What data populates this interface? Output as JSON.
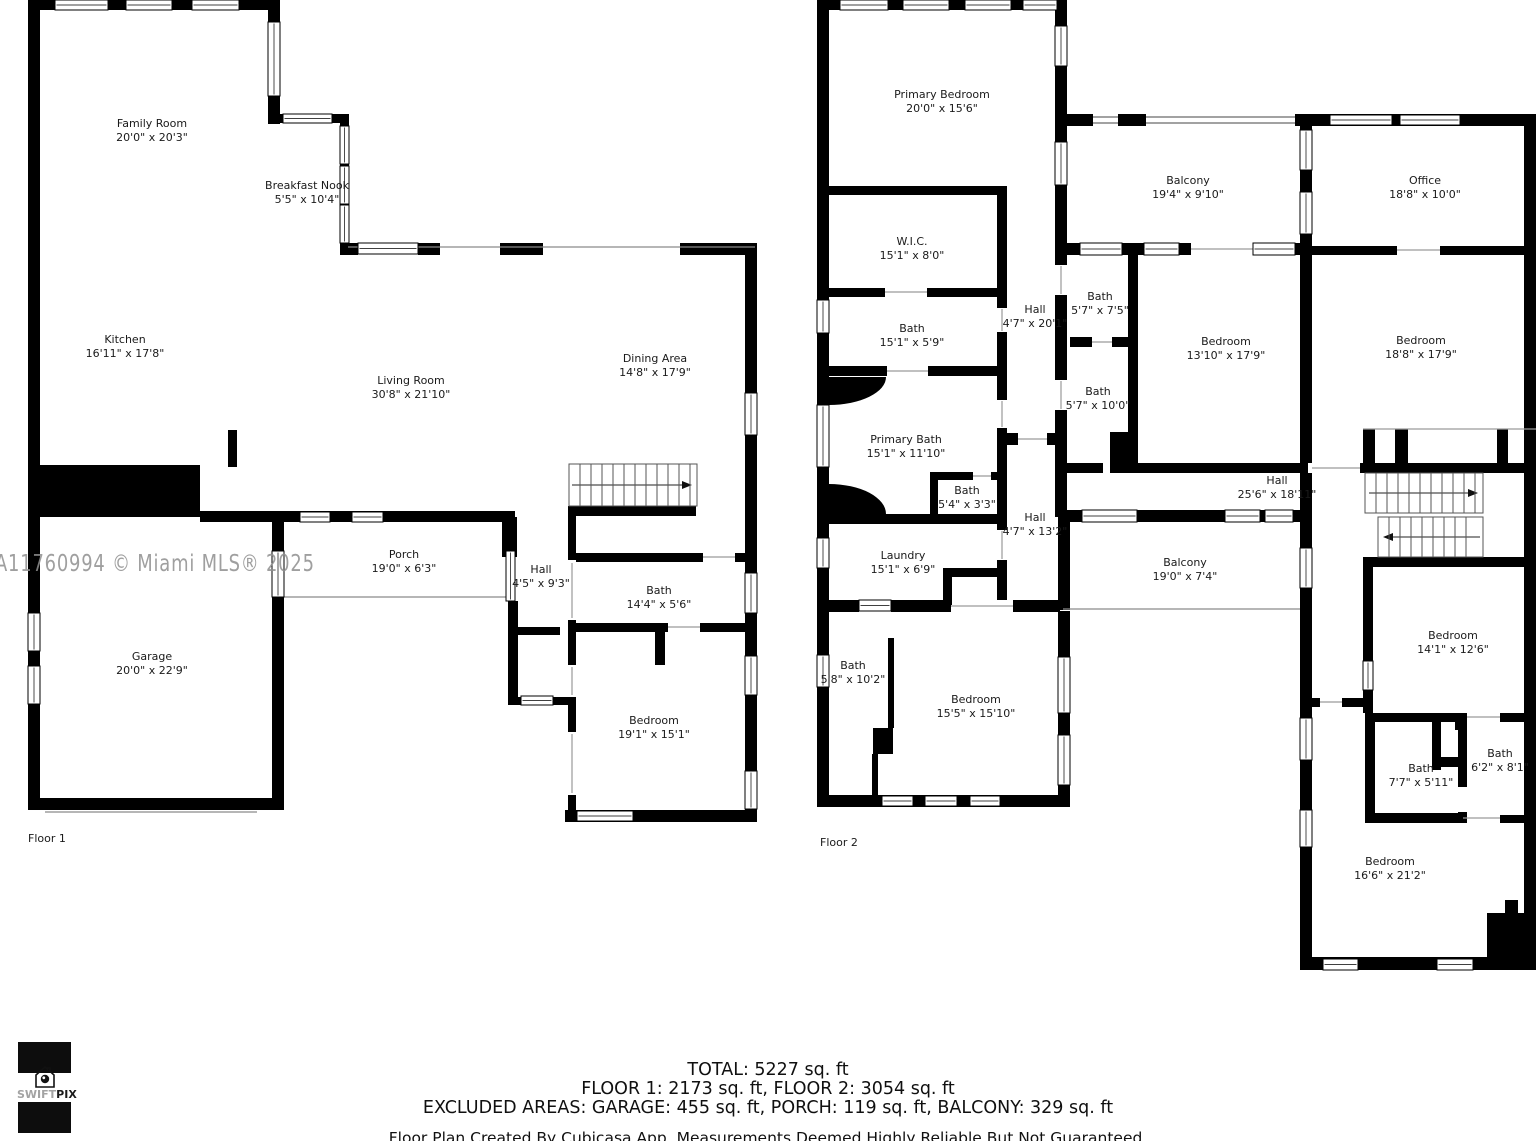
{
  "watermark": "A11760994 © Miami MLS® 2025",
  "logo": {
    "swift": "SWIFT",
    "pix": "PIX"
  },
  "floor1": {
    "label": "Floor 1",
    "rooms": [
      {
        "name": "Family Room",
        "dims": "20'0\" x 20'3\""
      },
      {
        "name": "Breakfast Nook",
        "dims": "5'5\" x 10'4\""
      },
      {
        "name": "Kitchen",
        "dims": "16'11\" x 17'8\""
      },
      {
        "name": "Living Room",
        "dims": "30'8\" x 21'10\""
      },
      {
        "name": "Dining Area",
        "dims": "14'8\" x 17'9\""
      },
      {
        "name": "Porch",
        "dims": "19'0\" x 6'3\""
      },
      {
        "name": "Hall",
        "dims": "4'5\" x 9'3\""
      },
      {
        "name": "Bath",
        "dims": "14'4\" x 5'6\""
      },
      {
        "name": "Bedroom",
        "dims": "19'1\" x 15'1\""
      },
      {
        "name": "Garage",
        "dims": "20'0\" x 22'9\""
      }
    ]
  },
  "floor2": {
    "label": "Floor 2",
    "rooms": [
      {
        "name": "Primary Bedroom",
        "dims": "20'0\" x 15'6\""
      },
      {
        "name": "W.I.C.",
        "dims": "15'1\" x 8'0\""
      },
      {
        "name": "Bath",
        "dims": "15'1\" x 5'9\""
      },
      {
        "name": "Primary Bath",
        "dims": "15'1\" x 11'10\""
      },
      {
        "name": "Bath",
        "dims": "5'4\" x 3'3\""
      },
      {
        "name": "Hall",
        "dims": "4'7\" x 20'1\""
      },
      {
        "name": "Hall",
        "dims": "4'7\" x 13'2\""
      },
      {
        "name": "Laundry",
        "dims": "15'1\" x 6'9\""
      },
      {
        "name": "Bath",
        "dims": "5'8\" x 10'2\""
      },
      {
        "name": "Bedroom",
        "dims": "15'5\" x 15'10\""
      },
      {
        "name": "Balcony",
        "dims": "19'4\" x 9'10\""
      },
      {
        "name": "Office",
        "dims": "18'8\" x 10'0\""
      },
      {
        "name": "Bath",
        "dims": "5'7\" x 7'5\""
      },
      {
        "name": "Bath",
        "dims": "5'7\" x 10'0\""
      },
      {
        "name": "Bedroom",
        "dims": "13'10\" x 17'9\""
      },
      {
        "name": "Bedroom",
        "dims": "18'8\" x 17'9\""
      },
      {
        "name": "Hall",
        "dims": "25'6\" x 18'11\""
      },
      {
        "name": "Balcony",
        "dims": "19'0\" x 7'4\""
      },
      {
        "name": "Bedroom",
        "dims": "14'1\" x 12'6\""
      },
      {
        "name": "Bath",
        "dims": "7'7\" x 5'11\""
      },
      {
        "name": "Bath",
        "dims": "6'2\" x 8'1\""
      },
      {
        "name": "Bedroom",
        "dims": "16'6\" x 21'2\""
      }
    ]
  },
  "summary": {
    "total": "TOTAL: 5227 sq. ft",
    "floors": "FLOOR 1: 2173 sq. ft, FLOOR 2: 3054 sq. ft",
    "excluded": "EXCLUDED AREAS: GARAGE: 455 sq. ft, PORCH: 119 sq. ft, BALCONY: 329 sq. ft",
    "disclaimer": "Floor Plan Created By Cubicasa App. Measurements Deemed Highly Reliable But Not Guaranteed."
  }
}
